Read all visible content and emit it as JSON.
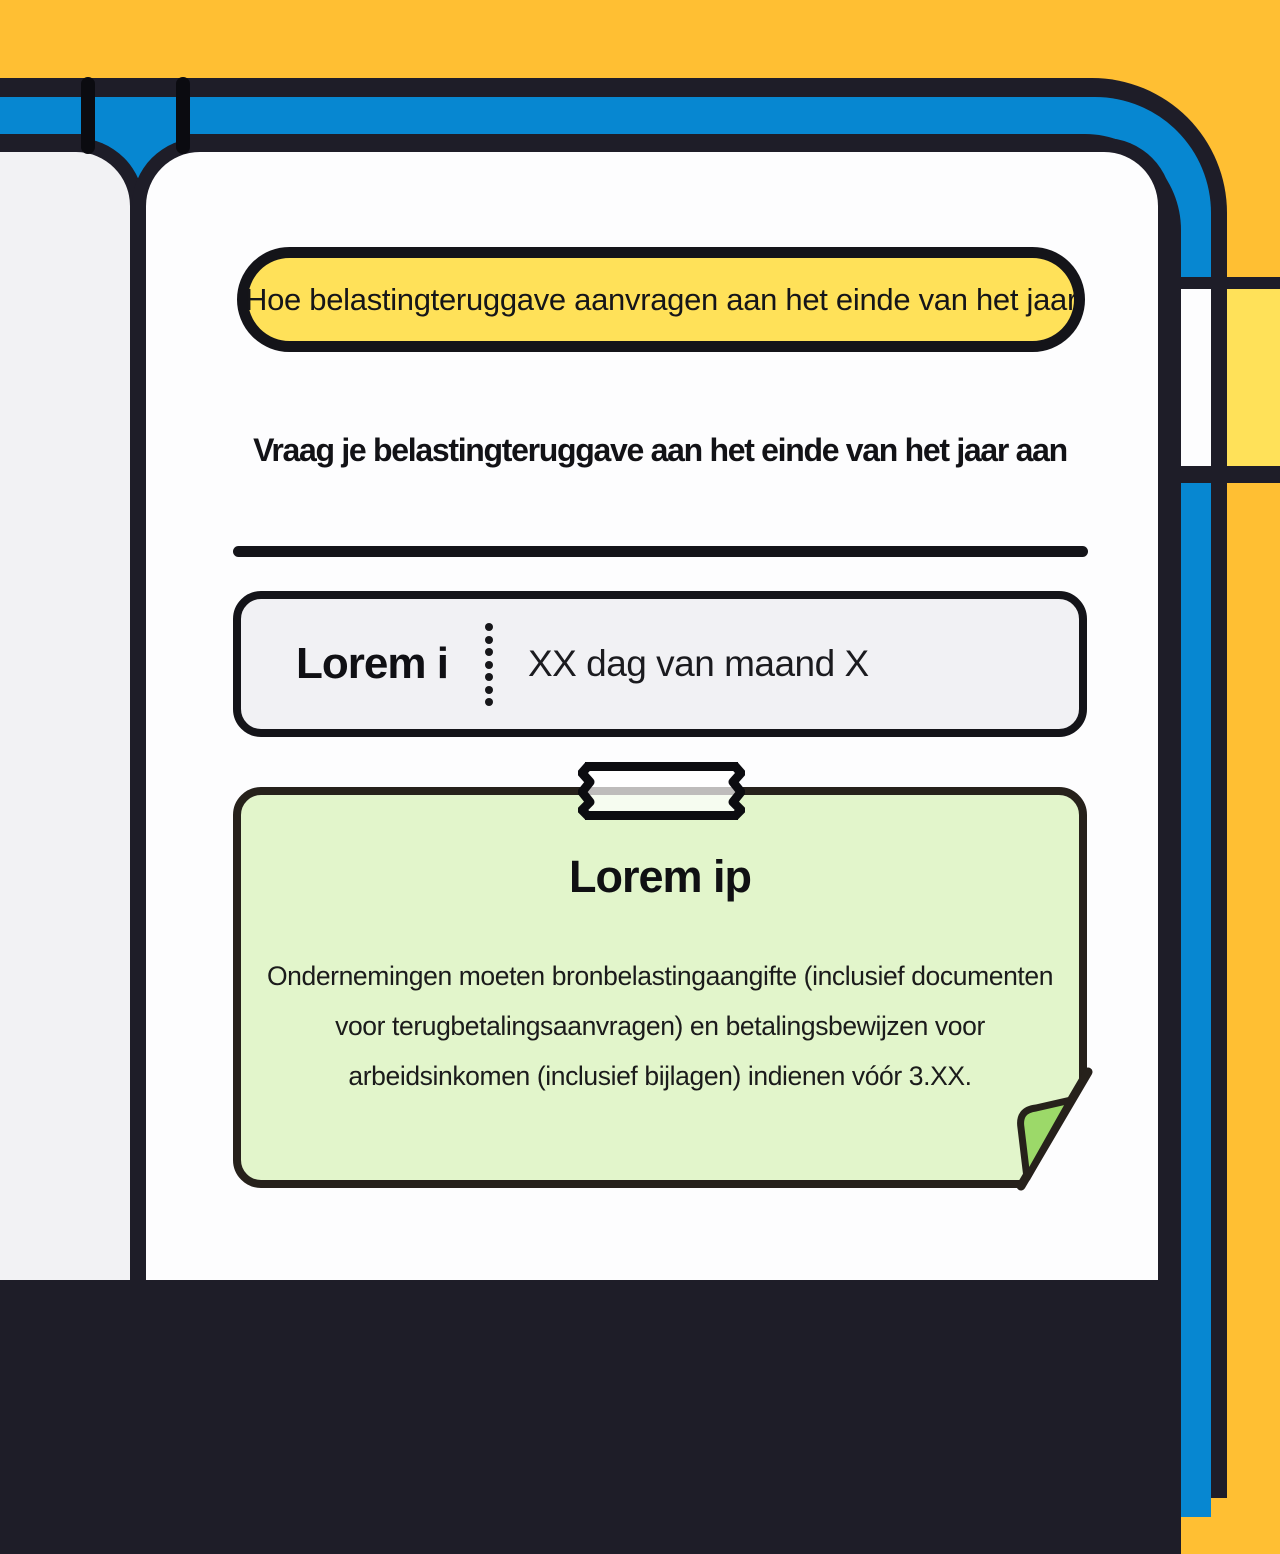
{
  "pill": {
    "title": "Hoe belastingteruggave aanvragen aan het einde van het jaar"
  },
  "heading": {
    "text": "Vraag je belastingteruggave aan het einde van het jaar aan"
  },
  "schedule": {
    "label": "Lorem i",
    "value": "XX dag van maand X"
  },
  "note": {
    "title": "Lorem ip",
    "body": "Ondernemingen moeten bronbelastingaangifte (inclusief documenten voor terugbetalingsaanvragen) en betalingsbewijzen voor arbeidsinkomen (inclusief bijlagen) indienen vóór 3.XX."
  },
  "palette": {
    "background_orange": "#FFBF33",
    "frame_blue": "#0787D1",
    "frame_ink": "#1E1D28",
    "pin_black": "#0B0B10",
    "left_page": "#F2F2F4",
    "main_page": "#FDFDFE",
    "highlight_yellow": "#FFE159",
    "accent_yellow_block": "#FFE159",
    "schedule_fill": "#F1F1F4",
    "note_fill": "#E2F5CB",
    "note_border": "#26211B",
    "fold_green": "#9CD969",
    "text_dark": "#17171A"
  }
}
